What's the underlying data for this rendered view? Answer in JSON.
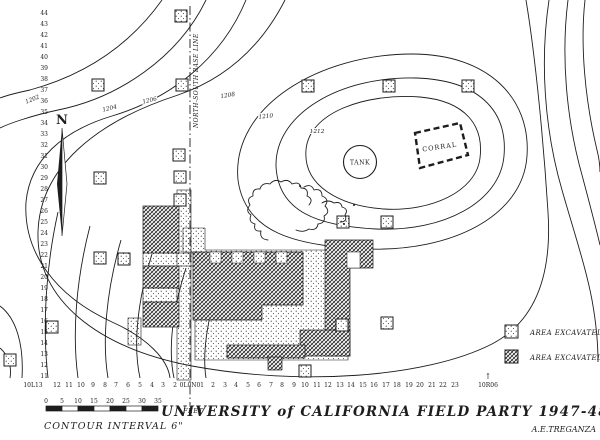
{
  "colors": {
    "ink": "#1d1d1d",
    "paper": "#ffffff"
  },
  "title": {
    "text": "UNIVERSITY of CALIFORNIA FIELD PARTY 1947-48",
    "author": "A.E.TREGANZA"
  },
  "labels": {
    "north": "N",
    "baseline": "NORTH-SOUTH BASE LINE",
    "tank": "TANK",
    "corral": "CORRAL",
    "contour_note": "CONTOUR INTERVAL 6\"",
    "feet_unit": "FEET",
    "datum_arrow": "↑"
  },
  "legend": {
    "items": [
      {
        "label": "AREA EXCAVATED - 1947",
        "pattern": "stipple"
      },
      {
        "label": "AREA EXCAVATED - 1948",
        "pattern": "crosshatch"
      }
    ]
  },
  "scale_bar": {
    "ticks": [
      "0",
      "5",
      "10",
      "15",
      "20",
      "25",
      "30",
      "35"
    ]
  },
  "contour_labels": [
    "1202",
    "1204",
    "1206",
    "1208",
    "1210",
    "1212"
  ],
  "grid": {
    "left_labels": [
      "44",
      "43",
      "42",
      "41",
      "40",
      "39",
      "38",
      "37",
      "36",
      "35",
      "34",
      "33",
      "32",
      "31",
      "30",
      "29",
      "28",
      "27",
      "26",
      "25",
      "24",
      "23",
      "22",
      "21",
      "20",
      "19",
      "18",
      "17",
      "16",
      "15",
      "14",
      "13",
      "12",
      "11"
    ],
    "bottom_labels": [
      "10L13",
      "12",
      "11",
      "10",
      "9",
      "8",
      "7",
      "6",
      "5",
      "4",
      "3",
      "2",
      "0L0N0",
      "1",
      "2",
      "3",
      "4",
      "5",
      "6",
      "7",
      "8",
      "9",
      "10",
      "11",
      "12",
      "13",
      "14",
      "15",
      "16",
      "17",
      "18",
      "19",
      "20",
      "21",
      "22",
      "23",
      "10R06"
    ]
  }
}
